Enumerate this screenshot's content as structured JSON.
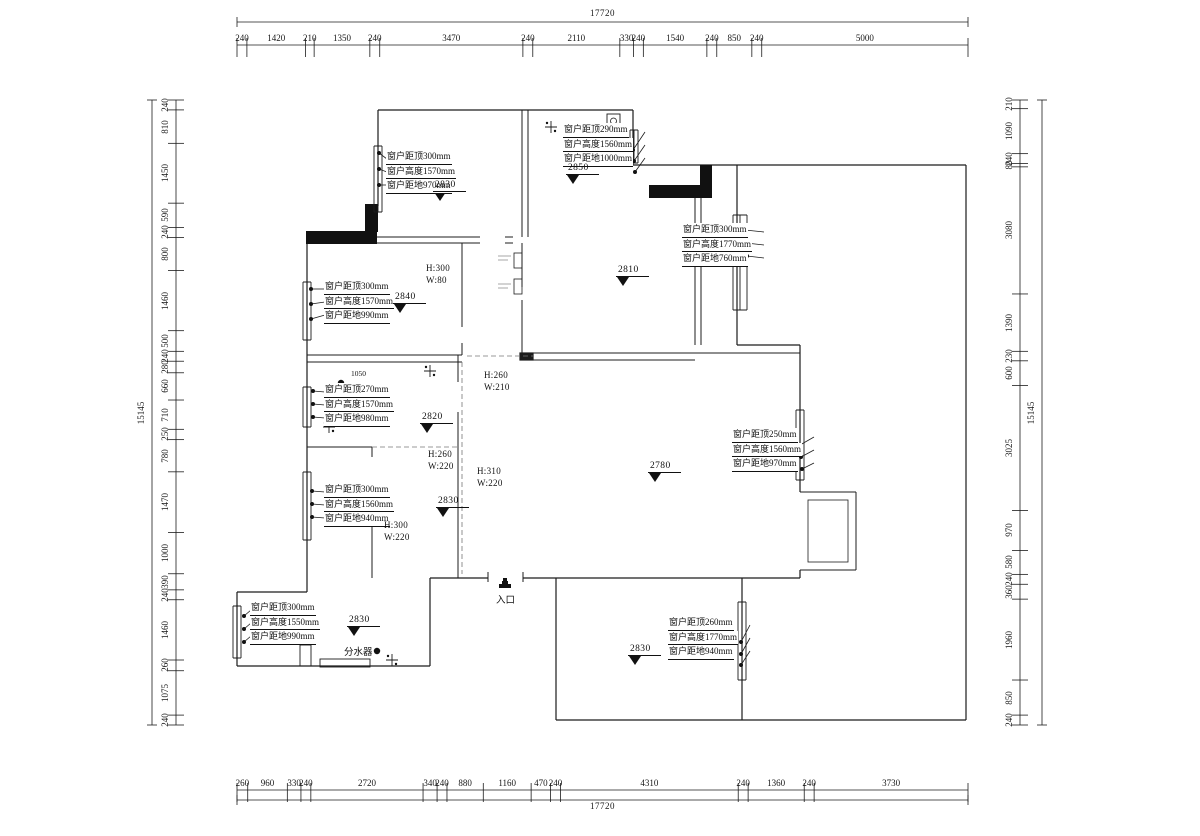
{
  "drawing": {
    "type": "floor-plan",
    "units": "mm",
    "line_color": "#1c1c1c"
  },
  "dimensions": {
    "top": {
      "total": "17720",
      "segments": [
        240,
        1420,
        210,
        1350,
        240,
        3470,
        240,
        2110,
        330,
        240,
        1540,
        240,
        850,
        240,
        5000
      ]
    },
    "bottom": {
      "total": "17720",
      "segments": [
        260,
        960,
        330,
        240,
        2720,
        340,
        240,
        880,
        1160,
        470,
        240,
        4310,
        240,
        1360,
        240,
        3730
      ]
    },
    "left": {
      "total": "15145",
      "segments": [
        240,
        810,
        1450,
        590,
        240,
        800,
        1460,
        500,
        240,
        280,
        660,
        710,
        250,
        780,
        1470,
        1000,
        390,
        240,
        1460,
        260,
        1075,
        240
      ]
    },
    "right": {
      "total": "15145",
      "segments": [
        210,
        1090,
        240,
        80,
        3080,
        1390,
        230,
        600,
        3025,
        970,
        580,
        240,
        360,
        1960,
        850,
        240
      ]
    }
  },
  "window_annotations": [
    {
      "lines": [
        "窗户距顶300mm",
        "窗户高度1570mm",
        "窗户距地970mm"
      ],
      "x": 386,
      "y": 150,
      "side": "left",
      "dots": [
        [
          379,
          153
        ],
        [
          379,
          169
        ],
        [
          379,
          185
        ]
      ]
    },
    {
      "lines": [
        "窗户距顶290mm",
        "窗户高度1560mm",
        "窗户距地1000mm"
      ],
      "x": 563,
      "y": 123,
      "side": "right",
      "dots": [
        [
          633,
          150
        ],
        [
          634,
          161
        ],
        [
          635,
          172
        ]
      ]
    },
    {
      "lines": [
        "窗户距顶300mm",
        "窗户高度1770mm",
        "窗户距地760mm"
      ],
      "x": 682,
      "y": 223,
      "side": "right",
      "dots": [
        [
          745,
          230
        ],
        [
          746,
          243
        ],
        [
          747,
          256
        ]
      ]
    },
    {
      "lines": [
        "窗户距顶300mm",
        "窗户高度1570mm",
        "窗户距地990mm"
      ],
      "x": 324,
      "y": 280,
      "side": "left",
      "dots": [
        [
          311,
          289
        ],
        [
          311,
          304
        ],
        [
          311,
          319
        ]
      ]
    },
    {
      "lines": [
        "窗户距顶270mm",
        "窗户高度1570mm",
        "窗户距地980mm"
      ],
      "x": 324,
      "y": 383,
      "side": "left",
      "dots": [
        [
          313,
          391
        ],
        [
          313,
          404
        ],
        [
          313,
          417
        ]
      ]
    },
    {
      "lines": [
        "窗户距顶300mm",
        "窗户高度1560mm",
        "窗户距地940mm"
      ],
      "x": 324,
      "y": 483,
      "side": "left",
      "dots": [
        [
          312,
          491
        ],
        [
          312,
          504
        ],
        [
          312,
          517
        ]
      ]
    },
    {
      "lines": [
        "窗户距顶250mm",
        "窗户高度1560mm",
        "窗户距地970mm"
      ],
      "x": 732,
      "y": 428,
      "side": "right",
      "dots": [
        [
          800,
          445
        ],
        [
          801,
          457
        ],
        [
          802,
          469
        ]
      ]
    },
    {
      "lines": [
        "窗户距顶300mm",
        "窗户高度1550mm",
        "窗户距地990mm"
      ],
      "x": 250,
      "y": 601,
      "side": "left",
      "dots": [
        [
          244,
          616
        ],
        [
          244,
          629
        ],
        [
          244,
          642
        ]
      ]
    },
    {
      "lines": [
        "窗户距顶260mm",
        "窗户高度1770mm",
        "窗户距地940mm"
      ],
      "x": 668,
      "y": 616,
      "side": "right",
      "dots": [
        [
          741,
          642
        ],
        [
          741,
          654
        ],
        [
          741,
          665
        ]
      ]
    }
  ],
  "level_marks": [
    {
      "value": "2830",
      "x": 433,
      "y": 180
    },
    {
      "value": "2850",
      "x": 566,
      "y": 163
    },
    {
      "value": "2810",
      "x": 616,
      "y": 265
    },
    {
      "value": "2840",
      "x": 393,
      "y": 292
    },
    {
      "value": "2820",
      "x": 420,
      "y": 412
    },
    {
      "value": "2830",
      "x": 436,
      "y": 496
    },
    {
      "value": "2780",
      "x": 648,
      "y": 461
    },
    {
      "value": "2830",
      "x": 347,
      "y": 615
    },
    {
      "value": "2830",
      "x": 628,
      "y": 644
    }
  ],
  "beam_labels": [
    {
      "h": "H:300",
      "w": "W:80",
      "x": 426,
      "y": 263
    },
    {
      "h": "H:260",
      "w": "W:210",
      "x": 484,
      "y": 370
    },
    {
      "h": "H:260",
      "w": "W:220",
      "x": 428,
      "y": 449
    },
    {
      "h": "H:310",
      "w": "W:220",
      "x": 477,
      "y": 466
    },
    {
      "h": "H:300",
      "w": "W:220",
      "x": 384,
      "y": 520
    }
  ],
  "misc_labels": [
    {
      "text": "入口",
      "x": 496,
      "y": 596,
      "cls": "misc"
    },
    {
      "text": "分水器",
      "x": 344,
      "y": 648,
      "cls": "misc"
    },
    {
      "text": "1050",
      "x": 351,
      "y": 369,
      "cls": "misc tiny"
    }
  ],
  "symbols": [
    {
      "type": "cross",
      "x": 551,
      "y": 127
    },
    {
      "type": "dot",
      "x": 582,
      "y": 129
    },
    {
      "type": "semicircle",
      "x": 572,
      "y": 141
    },
    {
      "type": "cross",
      "x": 430,
      "y": 371
    },
    {
      "type": "dot",
      "x": 341,
      "y": 383
    },
    {
      "type": "semicircle",
      "x": 377,
      "y": 384
    },
    {
      "type": "cross",
      "x": 329,
      "y": 427
    },
    {
      "type": "cross",
      "x": 392,
      "y": 660
    },
    {
      "type": "dot",
      "x": 377,
      "y": 651
    },
    {
      "type": "entrance",
      "x": 505,
      "y": 586
    }
  ]
}
